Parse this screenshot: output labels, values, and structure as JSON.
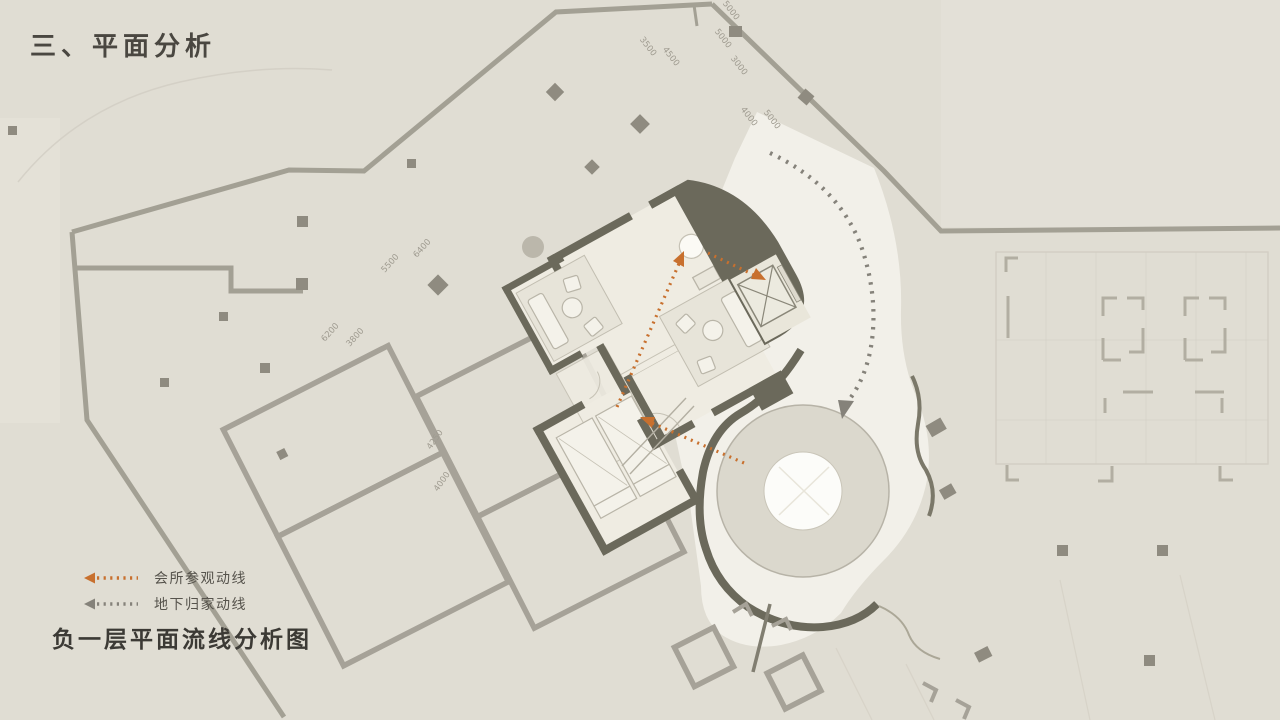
{
  "title": "三、平面分析",
  "caption": "负一层平面流线分析图",
  "legend": {
    "items": [
      {
        "id": "club-visit-route",
        "label": "会所参观动线",
        "color": "#c8702e"
      },
      {
        "id": "underground-home-route",
        "label": "地下归家动线",
        "color": "#85827a"
      }
    ]
  },
  "colors": {
    "background": "#e0ddd3",
    "panel_light": "#e5e2d8",
    "plaza": "#f2f0e9",
    "wall": "#6b695b",
    "site_line": "#a3a094",
    "parcel_line": "#a6a298",
    "ghost_line": "#cfcbc0",
    "column": "#8f8b80",
    "interior": "#efece2",
    "furniture": "#e9e6db",
    "furniture_line": "#b9b5a8",
    "ring_fill": "#dbd8cd",
    "ring_line": "#b7b3a7",
    "circle_fill": "#fcfcf9",
    "route_orange": "#c8702e",
    "route_gray": "#85827a",
    "dim_text": "#9f9b90",
    "title_text": "#4a4741",
    "legend_text": "#56534c",
    "caption_text": "#3c3a35"
  },
  "plan": {
    "dimension_labels": [
      {
        "text": "5000",
        "x": 729,
        "y": 12,
        "rot": 52
      },
      {
        "text": "5000",
        "x": 721,
        "y": 40,
        "rot": 52
      },
      {
        "text": "3500",
        "x": 646,
        "y": 48,
        "rot": 52
      },
      {
        "text": "4500",
        "x": 669,
        "y": 58,
        "rot": 52
      },
      {
        "text": "3000",
        "x": 737,
        "y": 67,
        "rot": 52
      },
      {
        "text": "4000",
        "x": 747,
        "y": 118,
        "rot": 52
      },
      {
        "text": "5000",
        "x": 770,
        "y": 121,
        "rot": 52
      },
      {
        "text": "6400",
        "x": 424,
        "y": 250,
        "rot": -48
      },
      {
        "text": "5500",
        "x": 392,
        "y": 265,
        "rot": -48
      },
      {
        "text": "6200",
        "x": 332,
        "y": 334,
        "rot": -48
      },
      {
        "text": "3800",
        "x": 357,
        "y": 339,
        "rot": -48
      },
      {
        "text": "4250",
        "x": 437,
        "y": 441,
        "rot": -55
      },
      {
        "text": "4000",
        "x": 444,
        "y": 483,
        "rot": -55
      }
    ]
  }
}
